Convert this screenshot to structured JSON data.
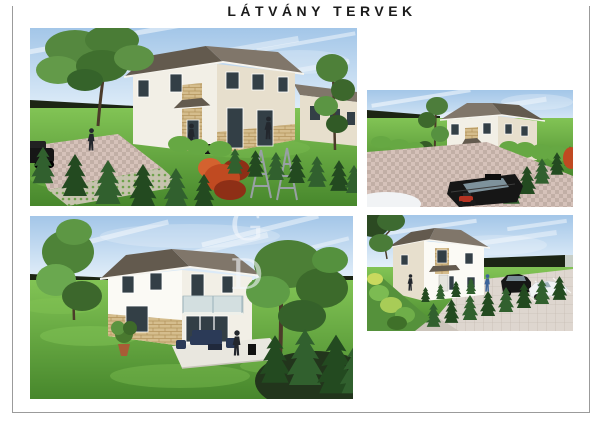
{
  "page": {
    "title": "LÁTVÁNY TERVEK",
    "watermark": "G D"
  },
  "palette": {
    "paper": "#ffffff",
    "border": "#9b9b9b",
    "title-color": "#1b1b1b",
    "sky-top": "#a3c6e8",
    "sky-bottom": "#e9f3fb",
    "cloud": "#ffffff",
    "grass-light": "#82c455",
    "grass-dark": "#47872c",
    "hedge-dark": "#1c2514",
    "conifer": "#31602e",
    "conifer-dark": "#234a20",
    "bush-light": "#66a843",
    "roof": "#80766a",
    "roof-dark": "#635a4e",
    "fascia": "#f6f4ee",
    "wall-light": "#f2efe6",
    "wall-mid": "#e7dfcd",
    "wall-white": "#fbfaf5",
    "stone": "#d5bd8d",
    "stone-dark": "#b3945c",
    "glass": "#333f46",
    "glass-light": "#8aa0ab",
    "frame": "#ffffff",
    "paver": "#d6c2ba",
    "paver-dark": "#ab968e",
    "paver-green-base": "#c6c3ae",
    "terrace": "#e9e7df",
    "furniture": "#2b3a57",
    "car-dark": "#161616",
    "car-white": "#f1f3f5",
    "red-bush": "#c04a21",
    "red-bush-dark": "#8e2f16",
    "trunk": "#4b3b29",
    "person-dark": "#23272d",
    "person-blue": "#3c639a",
    "watermark-color": "rgba(243,247,251,0.6)",
    "metal": "#98a0a5"
  }
}
